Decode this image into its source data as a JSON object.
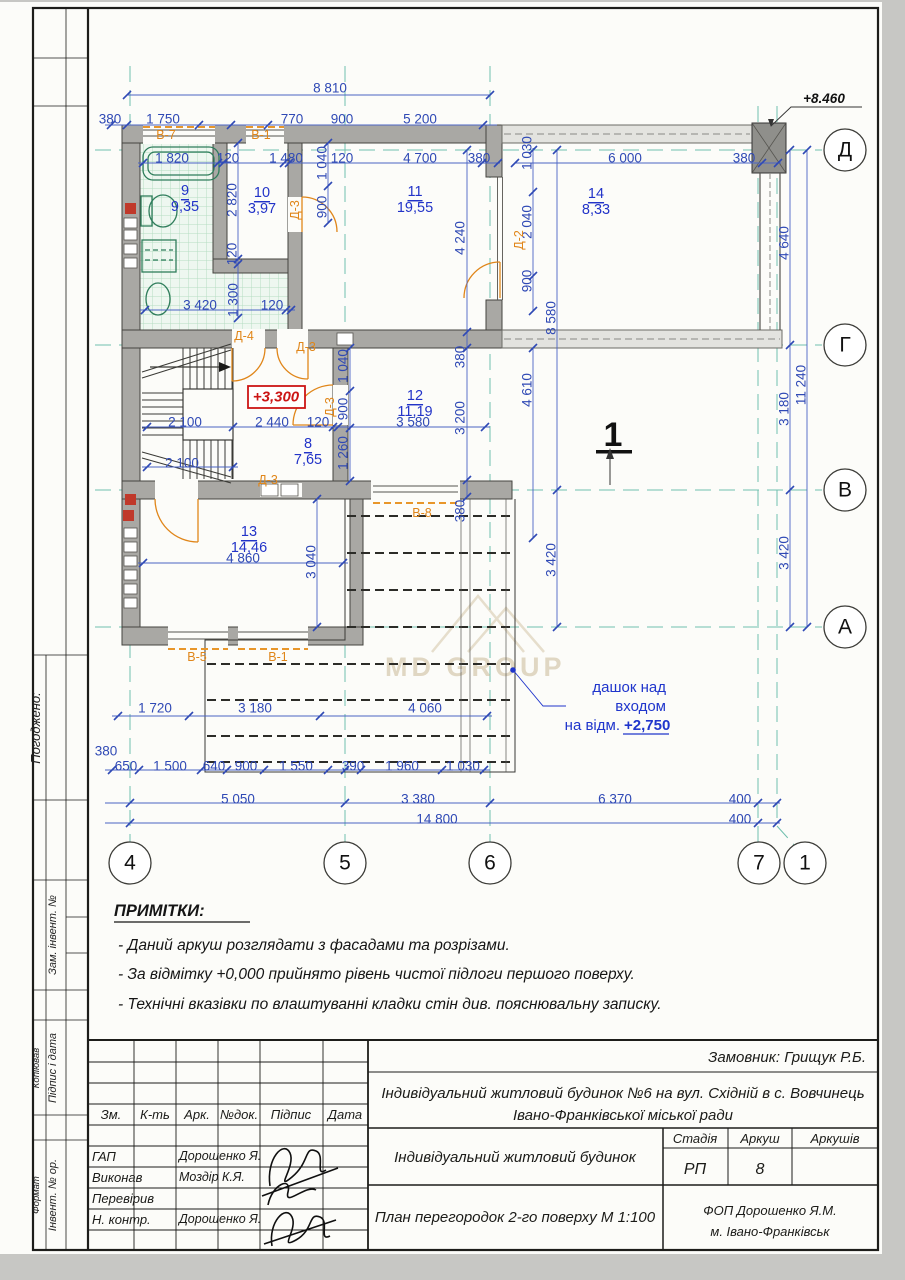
{
  "sidebar": {
    "agreed": "Погоджено:",
    "customer_inv": "Зам. інвент. №",
    "sign_date": "Підпис і дата",
    "copied": "Копіював",
    "inv_orig": "Інвент. № ор.",
    "format": "Формат"
  },
  "notes": {
    "heading": "ПРИМІТКИ:",
    "items": [
      "- Даний аркуш розглядати з фасадами та розрізами.",
      "- За відмітку +0,000 прийнято рівень чистої підлоги першого поверху.",
      "- Технічні вказівки по влаштуванні кладки стін див. пояснювальну записку."
    ]
  },
  "titleblock": {
    "customer": "Замовник: Грищук Р.Б.",
    "project_line1": "Індивідуальний житловий будинок  №6 на вул. Східній в с. Вовчинець",
    "project_line2": "Івано-Франківської міської ради",
    "object_name": "Індивідуальний житловий будинок",
    "drawing_title": "План перегородок  2-го поверху М 1:100",
    "org_line1": "ФОП Дорошенко Я.М.",
    "org_line2": "м. Івано-Франківськ",
    "headers": {
      "change": "Зм.",
      "count": "К-ть",
      "sheet": "Арк.",
      "docnum": "№док.",
      "signature": "Підпис",
      "date": "Дата"
    },
    "stage_label": "Стадія",
    "sheet_label": "Аркуш",
    "sheets_label": "Аркушів",
    "stage_value": "РП",
    "sheet_value": "8",
    "sheets_value": "",
    "rows": [
      {
        "role": "ГАП",
        "name": "Дорошенко Я."
      },
      {
        "role": "Виконав",
        "name": "Моздір К.Я."
      },
      {
        "role": "Перевірив",
        "name": ""
      },
      {
        "role": "Н. контр.",
        "name": "Дорошенко Я."
      }
    ]
  },
  "plan": {
    "watermark": "MD GROUP",
    "section_label": "1",
    "elevation_roof": "+8.460",
    "elevation_floor": "+3,300",
    "canopy_note_line1": "дашок над",
    "canopy_note_line2": "входом",
    "canopy_note_line3": "на відм.",
    "canopy_note_value": "+2,750",
    "axis_bubbles": [
      {
        "label": "Д",
        "x": 845,
        "y": 150
      },
      {
        "label": "Г",
        "x": 845,
        "y": 345
      },
      {
        "label": "В",
        "x": 845,
        "y": 490
      },
      {
        "label": "А",
        "x": 845,
        "y": 627
      },
      {
        "label": "4",
        "x": 130,
        "y": 863
      },
      {
        "label": "5",
        "x": 345,
        "y": 863
      },
      {
        "label": "6",
        "x": 490,
        "y": 863
      },
      {
        "label": "7",
        "x": 759,
        "y": 863
      },
      {
        "label": "1",
        "x": 805,
        "y": 863
      }
    ],
    "rooms": [
      {
        "num": "9",
        "area": "9,35",
        "x": 185,
        "y": 191
      },
      {
        "num": "10",
        "area": "3,97",
        "x": 262,
        "y": 193
      },
      {
        "num": "11",
        "area": "19,55",
        "x": 415,
        "y": 192
      },
      {
        "num": "14",
        "area": "8,33",
        "x": 596,
        "y": 194
      },
      {
        "num": "12",
        "area": "11,19",
        "x": 415,
        "y": 396
      },
      {
        "num": "8",
        "area": "7,65",
        "x": 308,
        "y": 444
      },
      {
        "num": "13",
        "area": "14,46",
        "x": 249,
        "y": 532
      }
    ],
    "opening_labels": [
      {
        "t": "В-7",
        "x": 166,
        "y": 135
      },
      {
        "t": "В-1",
        "x": 261,
        "y": 135
      },
      {
        "t": "Д-3",
        "x": 295,
        "y": 210,
        "r": 1
      },
      {
        "t": "Д-2",
        "x": 519,
        "y": 240,
        "r": 1
      },
      {
        "t": "Д-4",
        "x": 244,
        "y": 336
      },
      {
        "t": "Д-3",
        "x": 306,
        "y": 347
      },
      {
        "t": "Д-3",
        "x": 330,
        "y": 407,
        "r": 1
      },
      {
        "t": "Д-3",
        "x": 268,
        "y": 480
      },
      {
        "t": "В-8",
        "x": 422,
        "y": 513
      },
      {
        "t": "В-5",
        "x": 197,
        "y": 657
      },
      {
        "t": "В-1",
        "x": 278,
        "y": 657
      }
    ],
    "dims": [
      {
        "t": "8 810",
        "x": 330,
        "y": 88
      },
      {
        "t": "380",
        "x": 110,
        "y": 119
      },
      {
        "t": "1 750",
        "x": 163,
        "y": 119
      },
      {
        "t": "770",
        "x": 292,
        "y": 119
      },
      {
        "t": "900",
        "x": 342,
        "y": 119
      },
      {
        "t": "5 200",
        "x": 420,
        "y": 119
      },
      {
        "t": "1 820",
        "x": 172,
        "y": 158
      },
      {
        "t": "120",
        "x": 228,
        "y": 158
      },
      {
        "t": "1 480",
        "x": 286,
        "y": 158
      },
      {
        "t": "120",
        "x": 342,
        "y": 158
      },
      {
        "t": "4 700",
        "x": 420,
        "y": 158
      },
      {
        "t": "380",
        "x": 479,
        "y": 158
      },
      {
        "t": "6 000",
        "x": 625,
        "y": 158
      },
      {
        "t": "380",
        "x": 744,
        "y": 158
      },
      {
        "t": "3 420",
        "x": 200,
        "y": 305
      },
      {
        "t": "120",
        "x": 272,
        "y": 305
      },
      {
        "t": "2 100",
        "x": 185,
        "y": 422
      },
      {
        "t": "2 440",
        "x": 272,
        "y": 422
      },
      {
        "t": "120",
        "x": 318,
        "y": 422
      },
      {
        "t": "3 580",
        "x": 413,
        "y": 422
      },
      {
        "t": "2 100",
        "x": 182,
        "y": 463
      },
      {
        "t": "4 860",
        "x": 243,
        "y": 558
      },
      {
        "t": "1 720",
        "x": 155,
        "y": 708
      },
      {
        "t": "3 180",
        "x": 255,
        "y": 708
      },
      {
        "t": "4 060",
        "x": 425,
        "y": 708
      },
      {
        "t": "380",
        "x": 106,
        "y": 751
      },
      {
        "t": "650",
        "x": 126,
        "y": 766
      },
      {
        "t": "1 500",
        "x": 170,
        "y": 766
      },
      {
        "t": "640",
        "x": 214,
        "y": 766
      },
      {
        "t": "900",
        "x": 246,
        "y": 766
      },
      {
        "t": "1 550",
        "x": 296,
        "y": 766
      },
      {
        "t": "390",
        "x": 353,
        "y": 766
      },
      {
        "t": "1 960",
        "x": 402,
        "y": 766
      },
      {
        "t": "1 030",
        "x": 463,
        "y": 766
      },
      {
        "t": "5 050",
        "x": 238,
        "y": 799
      },
      {
        "t": "3 380",
        "x": 418,
        "y": 799
      },
      {
        "t": "6 370",
        "x": 615,
        "y": 799
      },
      {
        "t": "400",
        "x": 740,
        "y": 799
      },
      {
        "t": "14 800",
        "x": 437,
        "y": 819
      },
      {
        "t": "400",
        "x": 740,
        "y": 819
      },
      {
        "t": "1 030",
        "x": 527,
        "y": 153,
        "r": 1
      },
      {
        "t": "2 040",
        "x": 527,
        "y": 222,
        "r": 1
      },
      {
        "t": "900",
        "x": 527,
        "y": 281,
        "r": 1
      },
      {
        "t": "8 580",
        "x": 551,
        "y": 318,
        "r": 1
      },
      {
        "t": "4 610",
        "x": 527,
        "y": 390,
        "r": 1
      },
      {
        "t": "3 420",
        "x": 551,
        "y": 560,
        "r": 1
      },
      {
        "t": "4 640",
        "x": 784,
        "y": 243,
        "r": 1
      },
      {
        "t": "3 180",
        "x": 784,
        "y": 409,
        "r": 1
      },
      {
        "t": "3 420",
        "x": 784,
        "y": 553,
        "r": 1
      },
      {
        "t": "11 240",
        "x": 801,
        "y": 385,
        "r": 1
      },
      {
        "t": "2 820",
        "x": 232,
        "y": 200,
        "r": 1
      },
      {
        "t": "120",
        "x": 232,
        "y": 254,
        "r": 1
      },
      {
        "t": "1 300",
        "x": 233,
        "y": 300,
        "r": 1
      },
      {
        "t": "1 040",
        "x": 322,
        "y": 163,
        "r": 1
      },
      {
        "t": "900",
        "x": 322,
        "y": 207,
        "r": 1
      },
      {
        "t": "4 240",
        "x": 460,
        "y": 238,
        "r": 1
      },
      {
        "t": "380",
        "x": 460,
        "y": 357,
        "r": 1
      },
      {
        "t": "3 200",
        "x": 460,
        "y": 418,
        "r": 1
      },
      {
        "t": "380",
        "x": 460,
        "y": 511,
        "r": 1
      },
      {
        "t": "1 040",
        "x": 343,
        "y": 366,
        "r": 1
      },
      {
        "t": "900",
        "x": 343,
        "y": 409,
        "r": 1
      },
      {
        "t": "1 260",
        "x": 343,
        "y": 453,
        "r": 1
      },
      {
        "t": "3 040",
        "x": 311,
        "y": 562,
        "r": 1
      }
    ]
  }
}
